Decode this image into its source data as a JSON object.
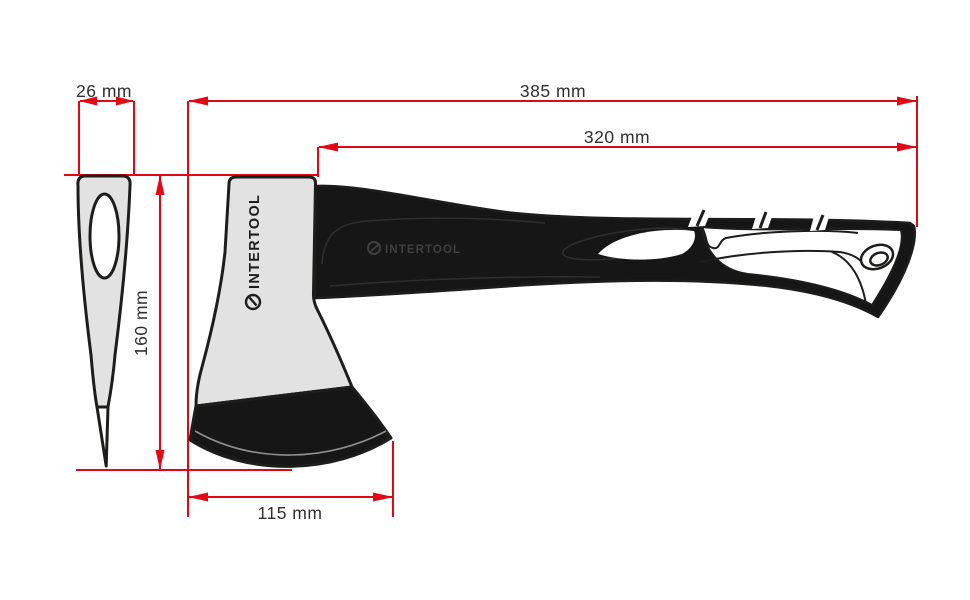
{
  "page": {
    "background": "#ffffff",
    "description_type": "product dimension diagram"
  },
  "colors": {
    "dimension_red": "#e30613",
    "outline_black": "#1d1d1b",
    "head_gray": "#e2e2e2",
    "label_gray": "#2f2f2e",
    "handle_black": "#161616",
    "handle_logo_gray": "#3f3f3f"
  },
  "dimensions": {
    "head_width": {
      "label": "26 mm",
      "value_mm": 26
    },
    "total_length": {
      "label": "385 mm",
      "value_mm": 385
    },
    "handle_length": {
      "label": "320 mm",
      "value_mm": 320
    },
    "head_height": {
      "label": "160 mm",
      "value_mm": 160
    },
    "blade_width": {
      "label": "115 mm",
      "value_mm": 115
    }
  },
  "branding": {
    "head_logo_text": "INTERTOOL",
    "handle_logo_text": "INTERTOOL"
  }
}
